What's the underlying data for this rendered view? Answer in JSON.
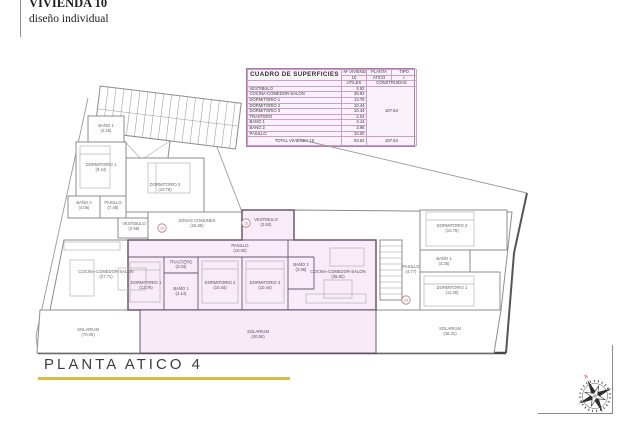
{
  "title_block": {
    "line1": "VIVIENDA 10",
    "line2": "diseño individual"
  },
  "surface_table": {
    "title": "CUADRO DE SUPERFICIES",
    "header": {
      "num_vivienda_label": "Nº VIVIENDA",
      "num_vivienda_value": "10",
      "planta_label": "PLANTA",
      "planta_value": "ATICO",
      "tipo_label": "TIPO",
      "tipo_value": "I"
    },
    "subheader": {
      "utiles": "UTILES",
      "construidas": "CONSTRUIDAS"
    },
    "rows": [
      {
        "label": "VESTIBULO",
        "utiles": "2.92"
      },
      {
        "label": "COCINA-COMEDOR-SALON",
        "utiles": "35.92"
      },
      {
        "label": "DORMITORIO 1",
        "utiles": "13.76"
      },
      {
        "label": "DORMITORIO 2",
        "utiles": "10.44"
      },
      {
        "label": "DORMITORIO 3",
        "utiles": "10.44"
      },
      {
        "label": "TRASTERO",
        "utiles": "2.04"
      },
      {
        "label": "BAÑO 1",
        "utiles": "4.14"
      },
      {
        "label": "BAÑO 2",
        "utiles": "3.96"
      },
      {
        "label": "PASILLO",
        "utiles": "10.00"
      }
    ],
    "construidas_merged": "107.64",
    "total": {
      "label": "TOTAL VIVIENDA 10",
      "utiles": "93.62",
      "construidas": "107.64"
    }
  },
  "plan": {
    "corridor": {
      "label": "ZONAS COMUNES",
      "value": "(25.56)"
    },
    "door_numbers": {
      "left": "15",
      "center": "16",
      "right": "14"
    },
    "unit_left": {
      "banyo1": {
        "label": "BAÑO 1",
        "value": "(4.16)"
      },
      "dormitorio1": {
        "label": "DORMITORIO 1",
        "value": "(9.44)"
      },
      "dormitorio2": {
        "label": "DORMITORIO 2",
        "value": "(10.78)"
      },
      "banyo2": {
        "label": "BAÑO 2",
        "value": "(4.05)"
      },
      "pasillo": {
        "label": "PASILLO",
        "value": "(7.48)"
      },
      "vestibulo": {
        "label": "VESTIBULO",
        "value": "(2.98)"
      },
      "cocina": {
        "label": "COCINA-COMEDOR-SALON",
        "value": "(27.71)"
      },
      "solarium": {
        "label": "SOLARIUM",
        "value": "(70.00)"
      }
    },
    "unit_10": {
      "vestibulo": {
        "label": "VESTIBULO",
        "value": "(2.92)"
      },
      "pasillo": {
        "label": "PASILLO",
        "value": "(10.00)"
      },
      "trastero": {
        "label": "TRASTERO",
        "value": "(2.04)"
      },
      "banyo1": {
        "label": "BAÑO 1",
        "value": "(4.14)"
      },
      "dormitorio1": {
        "label": "DORMITORIO 1",
        "value": "(13.76)"
      },
      "dormitorio2": {
        "label": "DORMITORIO 2",
        "value": "(10.44)"
      },
      "dormitorio3": {
        "label": "DORMITORIO 3",
        "value": "(10.44)"
      },
      "banyo2": {
        "label": "BAÑO 2",
        "value": "(3.96)"
      },
      "cocina": {
        "label": "COCINA-COMEDOR-SALON",
        "value": "(35.92)"
      },
      "solarium": {
        "label": "SOLARIUM",
        "value": "(40.50)"
      }
    },
    "unit_right": {
      "pasillo": {
        "label": "PASILLO",
        "value": "(4.77)"
      },
      "dormitorio2": {
        "label": "DORMITORIO 2",
        "value": "(10.75)"
      },
      "banyo1": {
        "label": "BAÑO 1",
        "value": "(4.35)"
      },
      "dormitorio1": {
        "label": "DORMITORIO 1",
        "value": "(11.36)"
      },
      "solarium": {
        "label": "SOLARIUM",
        "value": "(38.31)"
      }
    }
  },
  "footer": {
    "title": "PLANTA ATICO 4"
  },
  "compass": {
    "north": "N"
  },
  "colors": {
    "highlight_fill": "#f7ecf7",
    "table_border": "#a87aa8",
    "underline": "#d9bc4e",
    "north_red": "#c22222"
  }
}
